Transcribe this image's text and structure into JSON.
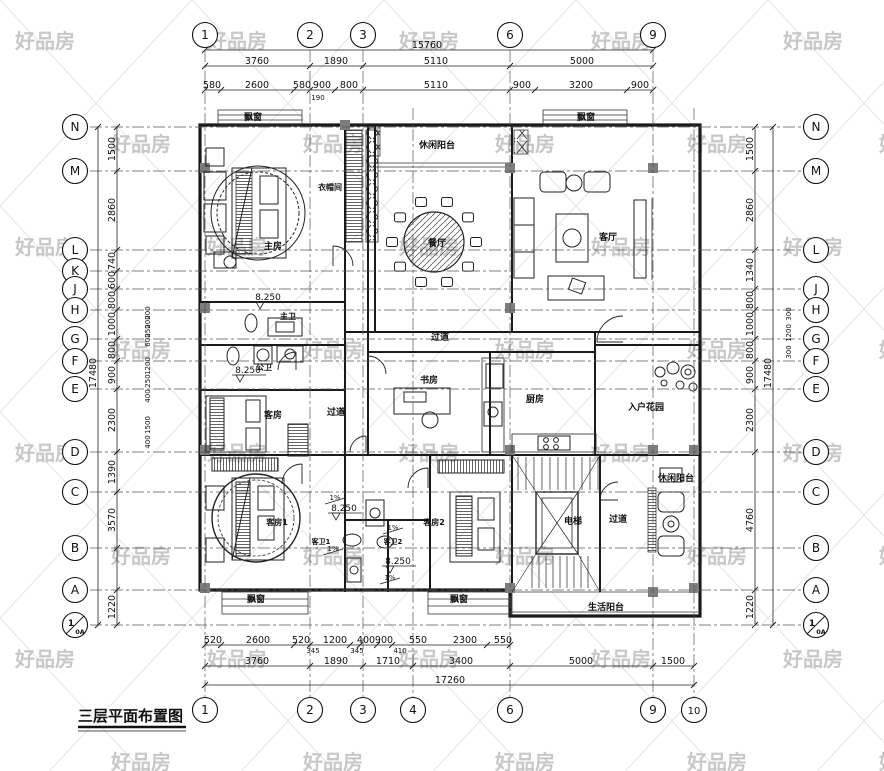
{
  "watermark": {
    "text": "好品房",
    "color": "#c7c7c7"
  },
  "title": {
    "text": "三层平面布置图"
  },
  "grid": {
    "vlines": [
      {
        "x": 205,
        "y1": 50,
        "y2": 698
      },
      {
        "x": 310,
        "y1": 50,
        "y2": 698
      },
      {
        "x": 363,
        "y1": 50,
        "y2": 698
      },
      {
        "x": 413,
        "y1": 108,
        "y2": 698
      },
      {
        "x": 510,
        "y1": 50,
        "y2": 698
      },
      {
        "x": 653,
        "y1": 50,
        "y2": 698
      },
      {
        "x": 694,
        "y1": 108,
        "y2": 698
      }
    ],
    "hlines": [
      {
        "y": 127,
        "x1": 90,
        "x2": 802
      },
      {
        "y": 171,
        "x1": 90,
        "x2": 802
      },
      {
        "y": 250,
        "x1": 90,
        "x2": 802
      },
      {
        "y": 271,
        "x1": 90,
        "x2": 512
      },
      {
        "y": 289,
        "x1": 90,
        "x2": 802
      },
      {
        "y": 310,
        "x1": 90,
        "x2": 802
      },
      {
        "y": 339,
        "x1": 90,
        "x2": 802
      },
      {
        "y": 361,
        "x1": 90,
        "x2": 802
      },
      {
        "y": 389,
        "x1": 90,
        "x2": 802
      },
      {
        "y": 452,
        "x1": 90,
        "x2": 802
      },
      {
        "y": 492,
        "x1": 90,
        "x2": 802
      },
      {
        "y": 548,
        "x1": 90,
        "x2": 802
      },
      {
        "y": 590,
        "x1": 90,
        "x2": 802
      },
      {
        "y": 625,
        "x1": 90,
        "x2": 802
      }
    ],
    "top_bubbles": [
      {
        "label": "1",
        "x": 205
      },
      {
        "label": "2",
        "x": 310
      },
      {
        "label": "3",
        "x": 363
      },
      {
        "label": "6",
        "x": 510
      },
      {
        "label": "9",
        "x": 653
      }
    ],
    "bottom_bubbles": [
      {
        "label": "1",
        "x": 205
      },
      {
        "label": "2",
        "x": 310
      },
      {
        "label": "3",
        "x": 363
      },
      {
        "label": "4",
        "x": 413
      },
      {
        "label": "6",
        "x": 510
      },
      {
        "label": "9",
        "x": 653
      },
      {
        "label": "10",
        "x": 694
      }
    ],
    "left_bubbles": [
      {
        "label": "N",
        "y": 127
      },
      {
        "label": "M",
        "y": 171
      },
      {
        "label": "L",
        "y": 250
      },
      {
        "label": "K",
        "y": 271
      },
      {
        "label": "J",
        "y": 289
      },
      {
        "label": "H",
        "y": 310
      },
      {
        "label": "G",
        "y": 339
      },
      {
        "label": "F",
        "y": 361
      },
      {
        "label": "E",
        "y": 389
      },
      {
        "label": "D",
        "y": 452
      },
      {
        "label": "C",
        "y": 492
      },
      {
        "label": "B",
        "y": 548
      },
      {
        "label": "A",
        "y": 590
      },
      {
        "label": "1",
        "sub": "0A",
        "y": 625
      }
    ],
    "right_bubbles": [
      {
        "label": "N",
        "y": 127
      },
      {
        "label": "M",
        "y": 171
      },
      {
        "label": "L",
        "y": 250
      },
      {
        "label": "J",
        "y": 289
      },
      {
        "label": "H",
        "y": 310
      },
      {
        "label": "G",
        "y": 339
      },
      {
        "label": "F",
        "y": 361
      },
      {
        "label": "E",
        "y": 389
      },
      {
        "label": "D",
        "y": 452
      },
      {
        "label": "C",
        "y": 492
      },
      {
        "label": "B",
        "y": 548
      },
      {
        "label": "A",
        "y": 590
      },
      {
        "label": "1",
        "sub": "0A",
        "y": 625
      }
    ]
  },
  "dims": {
    "top": [
      {
        "y": 50,
        "x1": 205,
        "x2": 653,
        "ticks": [
          205,
          653
        ],
        "labels": [
          {
            "t": "15760",
            "x": 427
          }
        ]
      },
      {
        "y": 66,
        "x1": 205,
        "x2": 653,
        "ticks": [
          205,
          310,
          363,
          510,
          653
        ],
        "labels": [
          {
            "t": "3760",
            "x": 257
          },
          {
            "t": "1890",
            "x": 336
          },
          {
            "t": "5110",
            "x": 436
          },
          {
            "t": "5000",
            "x": 582
          }
        ]
      },
      {
        "y": 90,
        "x1": 205,
        "x2": 653,
        "ticks": [
          205,
          221,
          294,
          310,
          335,
          363,
          510,
          535,
          627,
          653
        ],
        "labels": [
          {
            "t": "580",
            "x": 212
          },
          {
            "t": "2600",
            "x": 257
          },
          {
            "t": "580",
            "x": 302
          },
          {
            "t": "900",
            "x": 322
          },
          {
            "t": "800",
            "x": 349
          },
          {
            "t": "5110",
            "x": 436
          },
          {
            "t": "900",
            "x": 522
          },
          {
            "t": "3200",
            "x": 581
          },
          {
            "t": "900",
            "x": 640
          },
          {
            "t": "190",
            "x": 318,
            "dy": 12,
            "small": true
          }
        ]
      }
    ],
    "bottom": [
      {
        "y": 645,
        "x1": 205,
        "x2": 510,
        "ticks": [
          205,
          221,
          294,
          310,
          350,
          360,
          377,
          392,
          487,
          510
        ],
        "labels": [
          {
            "t": "520",
            "x": 213
          },
          {
            "t": "2600",
            "x": 258
          },
          {
            "t": "520",
            "x": 301
          },
          {
            "t": "1200",
            "x": 335
          },
          {
            "t": "400",
            "x": 366
          },
          {
            "t": "900",
            "x": 384
          },
          {
            "t": "550",
            "x": 418
          },
          {
            "t": "2300",
            "x": 465
          },
          {
            "t": "550",
            "x": 503
          },
          {
            "t": "345",
            "x": 313,
            "dy": 10,
            "small": true
          },
          {
            "t": "345",
            "x": 357,
            "dy": 10,
            "small": true
          },
          {
            "t": "410",
            "x": 400,
            "dy": 10,
            "small": true
          }
        ]
      },
      {
        "y": 666,
        "x1": 205,
        "x2": 694,
        "ticks": [
          205,
          310,
          363,
          413,
          510,
          653,
          694
        ],
        "labels": [
          {
            "t": "3760",
            "x": 257
          },
          {
            "t": "1890",
            "x": 336
          },
          {
            "t": "1710",
            "x": 388
          },
          {
            "t": "3400",
            "x": 461
          },
          {
            "t": "5000",
            "x": 581
          },
          {
            "t": "1500",
            "x": 673
          }
        ]
      },
      {
        "y": 685,
        "x1": 205,
        "x2": 694,
        "ticks": [
          205,
          694
        ],
        "labels": [
          {
            "t": "17260",
            "x": 450
          }
        ]
      }
    ],
    "left": [
      {
        "x": 117,
        "y1": 127,
        "y2": 625,
        "ticks": [
          127,
          171,
          250,
          271,
          289,
          310,
          339,
          361,
          389,
          452,
          492,
          548,
          590,
          625
        ],
        "labels": [
          {
            "t": "1500",
            "y": 149
          },
          {
            "t": "2860",
            "y": 210
          },
          {
            "t": "740",
            "y": 261
          },
          {
            "t": "600",
            "y": 280
          },
          {
            "t": "800",
            "y": 300
          },
          {
            "t": "1000",
            "y": 324
          },
          {
            "t": "800",
            "y": 350
          },
          {
            "t": "900",
            "y": 375
          },
          {
            "t": "2300",
            "y": 420
          },
          {
            "t": "1390",
            "y": 472
          },
          {
            "t": "3570",
            "y": 520
          },
          {
            "t": "1220",
            "y": 607
          }
        ]
      },
      {
        "x": 98,
        "y1": 127,
        "y2": 625,
        "ticks": [
          127,
          625
        ],
        "labels": [
          {
            "t": "17480",
            "y": 373
          }
        ]
      },
      {
        "x": 152,
        "labels": [
          {
            "t": "200",
            "y": 313,
            "small": true
          },
          {
            "t": "200",
            "y": 322,
            "small": true
          },
          {
            "t": "250",
            "y": 331,
            "small": true
          },
          {
            "t": "600",
            "y": 340,
            "small": true
          },
          {
            "t": "1200",
            "y": 366,
            "small": true
          },
          {
            "t": "250",
            "y": 381,
            "small": true
          },
          {
            "t": "400",
            "y": 396,
            "small": true
          },
          {
            "t": "1500",
            "y": 425,
            "small": true
          },
          {
            "t": "400",
            "y": 442,
            "small": true
          }
        ]
      }
    ],
    "right": [
      {
        "x": 755,
        "y1": 127,
        "y2": 625,
        "ticks": [
          127,
          171,
          250,
          289,
          310,
          339,
          361,
          389,
          452,
          590,
          625
        ],
        "labels": [
          {
            "t": "1500",
            "y": 149
          },
          {
            "t": "2860",
            "y": 210
          },
          {
            "t": "1340",
            "y": 270
          },
          {
            "t": "800",
            "y": 300
          },
          {
            "t": "1000",
            "y": 324
          },
          {
            "t": "800",
            "y": 350
          },
          {
            "t": "900",
            "y": 375
          },
          {
            "t": "2300",
            "y": 420
          },
          {
            "t": "4760",
            "y": 520
          },
          {
            "t": "1220",
            "y": 607
          }
        ]
      },
      {
        "x": 773,
        "y1": 127,
        "y2": 625,
        "ticks": [
          127,
          625
        ],
        "labels": [
          {
            "t": "17480",
            "y": 373
          }
        ]
      },
      {
        "x": 793,
        "labels": [
          {
            "t": "300",
            "y": 314,
            "small": true
          },
          {
            "t": "1200",
            "y": 333,
            "small": true
          },
          {
            "t": "300",
            "y": 352,
            "small": true
          }
        ]
      }
    ]
  },
  "labels": [
    {
      "t": "飘窗",
      "x": 253,
      "y": 120,
      "s": 9
    },
    {
      "t": "飘窗",
      "x": 586,
      "y": 120,
      "s": 9
    },
    {
      "t": "休闲阳台",
      "x": 437,
      "y": 148,
      "s": 9
    },
    {
      "t": "衣帽间",
      "x": 330,
      "y": 190,
      "s": 8
    },
    {
      "t": "主房",
      "x": 273,
      "y": 249,
      "s": 9
    },
    {
      "t": "餐厅",
      "x": 437,
      "y": 246,
      "s": 9
    },
    {
      "t": "客厅",
      "x": 608,
      "y": 240,
      "s": 9
    },
    {
      "t": "主卫",
      "x": 288,
      "y": 319,
      "s": 8
    },
    {
      "t": "公卫",
      "x": 264,
      "y": 370,
      "s": 8
    },
    {
      "t": "过道",
      "x": 440,
      "y": 340,
      "s": 9
    },
    {
      "t": "过道",
      "x": 336,
      "y": 415,
      "s": 9
    },
    {
      "t": "书房",
      "x": 429,
      "y": 383,
      "s": 9
    },
    {
      "t": "厨房",
      "x": 535,
      "y": 402,
      "s": 9
    },
    {
      "t": "入户花园",
      "x": 646,
      "y": 410,
      "s": 9
    },
    {
      "t": "客房",
      "x": 273,
      "y": 418,
      "s": 9
    },
    {
      "t": "客房1",
      "x": 277,
      "y": 525,
      "s": 8
    },
    {
      "t": "客房2",
      "x": 434,
      "y": 525,
      "s": 8
    },
    {
      "t": "客卫1",
      "x": 321,
      "y": 544,
      "s": 7
    },
    {
      "t": "客卫2",
      "x": 393,
      "y": 544,
      "s": 7
    },
    {
      "t": "电梯",
      "x": 573,
      "y": 524,
      "s": 9
    },
    {
      "t": "过道",
      "x": 618,
      "y": 522,
      "s": 9
    },
    {
      "t": "休闲阳台",
      "x": 676,
      "y": 481,
      "s": 9
    },
    {
      "t": "生活阳台",
      "x": 606,
      "y": 610,
      "s": 9
    },
    {
      "t": "飘窗",
      "x": 256,
      "y": 602,
      "s": 9
    },
    {
      "t": "飘窗",
      "x": 459,
      "y": 602,
      "s": 9
    }
  ],
  "elevations": [
    {
      "t": "8.250",
      "x": 268,
      "y": 300
    },
    {
      "t": "8.250",
      "x": 248,
      "y": 373
    },
    {
      "t": "8.250",
      "x": 344,
      "y": 511
    },
    {
      "t": "8.250",
      "x": 398,
      "y": 564
    }
  ],
  "slopes": [
    {
      "t": "1%",
      "x": 335,
      "y": 500
    },
    {
      "t": "1%",
      "x": 393,
      "y": 530
    },
    {
      "t": "1%",
      "x": 333,
      "y": 551
    },
    {
      "t": "1%",
      "x": 390,
      "y": 580
    }
  ]
}
